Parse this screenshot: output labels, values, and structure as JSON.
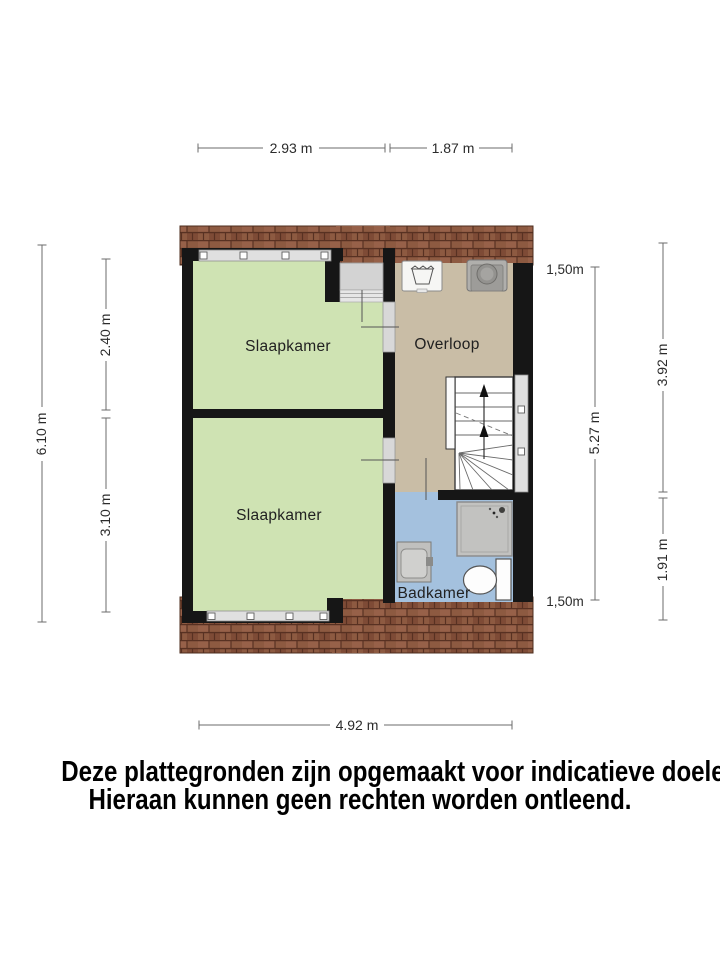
{
  "colors": {
    "background": "#ffffff",
    "wall": "#161616",
    "bedroom": "#cfe3b3",
    "landing": "#c9bda6",
    "bathroom": "#a4c1de",
    "roof": "#8d5a41",
    "roof_line": "#583122",
    "window": "#e0e0e0",
    "dim_text": "#2b2b2b"
  },
  "rooms": {
    "bedroom_top": {
      "label": "Slaapkamer"
    },
    "bedroom_bottom": {
      "label": "Slaapkamer"
    },
    "landing": {
      "label": "Overloop"
    },
    "bathroom": {
      "label": "Badkamer"
    }
  },
  "fixtures": {
    "landing": [
      "washing-machine",
      "dryer"
    ],
    "bathroom": [
      "shower",
      "washbasin",
      "toilet"
    ],
    "staircase": "stairs-up-arrow"
  },
  "dimensions": {
    "width_bedrooms": "2.93 m",
    "width_landing": "1.87 m",
    "height_total": "6.10 m",
    "height_bedroom_top": "2.40 m",
    "height_bedroom_bottom": "3.10 m",
    "height_inner_right": "5.27 m",
    "height_landing_right": "3.92 m",
    "height_bathroom_right": "1.91 m",
    "width_total": "4.92 m",
    "knee_wall_top": "1,50m",
    "knee_wall_bottom": "1,50m"
  },
  "disclaimer": {
    "line1": "Deze plattegronden zijn opgemaakt voor indicatieve doeleinden.",
    "line2": "Hieraan kunnen geen rechten worden ontleend."
  }
}
